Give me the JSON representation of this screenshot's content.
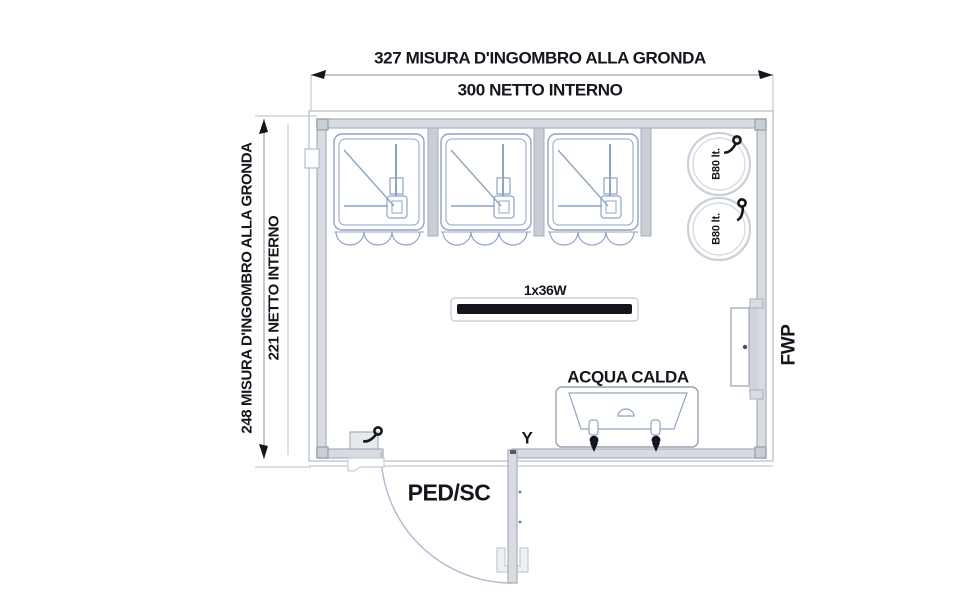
{
  "drawing": {
    "type": "floor-plan",
    "dimensions": {
      "top_outer": "327 MISURA D'INGOMBRO ALLA GRONDA",
      "top_inner": "300 NETTO INTERNO",
      "left_outer": "248 MISURA D'INGOMBRO ALLA GRONDA",
      "left_inner": "221 NETTO INTERNO"
    },
    "labels": {
      "light_fixture": "1x36W",
      "hot_water": "ACQUA CALDA",
      "door": "PED/SC",
      "window": "FWP",
      "boiler_top": "B80 lt.",
      "boiler_bottom": "B80 lt.",
      "floor_drain": "Y"
    },
    "fixtures": {
      "shower_stalls": 3,
      "boilers": 2,
      "wash_trough_taps": 2
    },
    "colors": {
      "ink": "#15151d",
      "wall_fill": "#d8dce2",
      "wall_edge": "#a7afb9",
      "fixture_line": "#8ea4c4",
      "detail_line": "#c6cdd5",
      "dim_line": "#9aa5b0",
      "door_arc": "#b0bcd0"
    }
  }
}
